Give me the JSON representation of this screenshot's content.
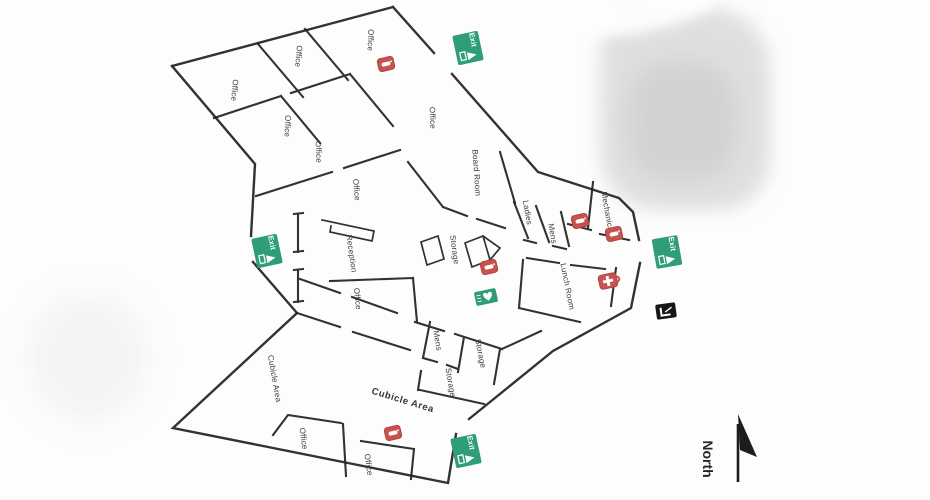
{
  "colors": {
    "wall": "#222222",
    "exit_green": "#2f9e78",
    "extinguisher_red": "#c9524e",
    "alarm_black": "#161616",
    "label_text": "#3a3a3a"
  },
  "compass": {
    "label": "North"
  },
  "signage": {
    "exit_label": "Exit"
  },
  "icons": {
    "exit": "exit-running-man",
    "extinguisher": "fire-extinguisher",
    "first_aid": "first-aid-kit",
    "aed": "aed-heart",
    "fire_alarm": "fire-alarm-pull-station",
    "compass": "north-arrow"
  },
  "rooms": [
    {
      "id": "office-a",
      "label": "Office"
    },
    {
      "id": "office-b",
      "label": "Office"
    },
    {
      "id": "office-c",
      "label": "Office"
    },
    {
      "id": "office-d",
      "label": "Office"
    },
    {
      "id": "office-e",
      "label": "Office"
    },
    {
      "id": "office-f",
      "label": "Office"
    },
    {
      "id": "office-g",
      "label": "Office"
    },
    {
      "id": "board-room",
      "label": "Board Room"
    },
    {
      "id": "reception",
      "label": "Reception"
    },
    {
      "id": "storage-hub",
      "label": "Storage"
    },
    {
      "id": "ladies",
      "label": "Ladies"
    },
    {
      "id": "mens-upper",
      "label": "Mens"
    },
    {
      "id": "mechanical",
      "label": "Mechanical"
    },
    {
      "id": "lunch-room",
      "label": "Lunch Room"
    },
    {
      "id": "office-h",
      "label": "Office"
    },
    {
      "id": "cubicle-area-left",
      "label": "Cubicle Area"
    },
    {
      "id": "mens-lower",
      "label": "Mens"
    },
    {
      "id": "storage-a",
      "label": "Storage"
    },
    {
      "id": "storage-b",
      "label": "Storage"
    },
    {
      "id": "cubicle-area-main",
      "label": "Cubicle Area"
    },
    {
      "id": "office-i",
      "label": "Office"
    },
    {
      "id": "office-j",
      "label": "Office"
    }
  ]
}
